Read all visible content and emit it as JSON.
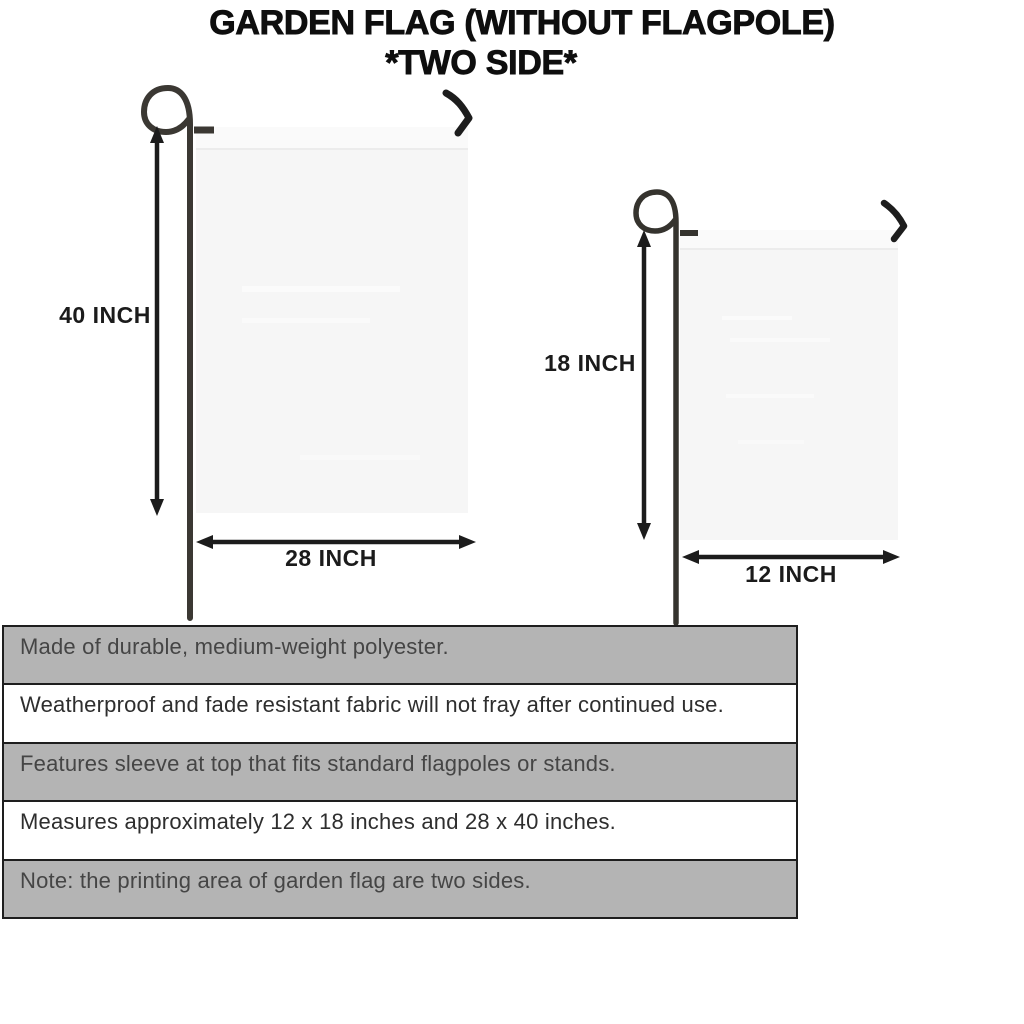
{
  "title": {
    "line1": "GARDEN FLAG (WITHOUT FLAGPOLE)",
    "line2": "*TWO SIDE*"
  },
  "diagrams": {
    "large_flag": {
      "height_label": "40 INCH",
      "width_label": "28 INCH"
    },
    "small_flag": {
      "height_label": "18 INCH",
      "width_label": "12 INCH"
    }
  },
  "features": {
    "rows": [
      {
        "text": "Made of durable, medium-weight polyester.",
        "shaded": true
      },
      {
        "text": "Weatherproof and fade resistant fabric will not fray after continued use.",
        "shaded": false
      },
      {
        "text": "Features sleeve at top that fits standard flagpoles or stands.",
        "shaded": true
      },
      {
        "text": "Measures approximately 12 x 18 inches and 28 x 40 inches.",
        "shaded": false
      },
      {
        "text": "Note: the printing area of garden flag are two sides.",
        "shaded": true
      }
    ]
  },
  "colors": {
    "row_shaded": "#b4b4b4",
    "row_plain": "#ffffff",
    "flag_fill": "#f6f6f6",
    "pole": "#3b3833",
    "ink": "#1c1c1c",
    "body_text": "#3c3c3c"
  }
}
